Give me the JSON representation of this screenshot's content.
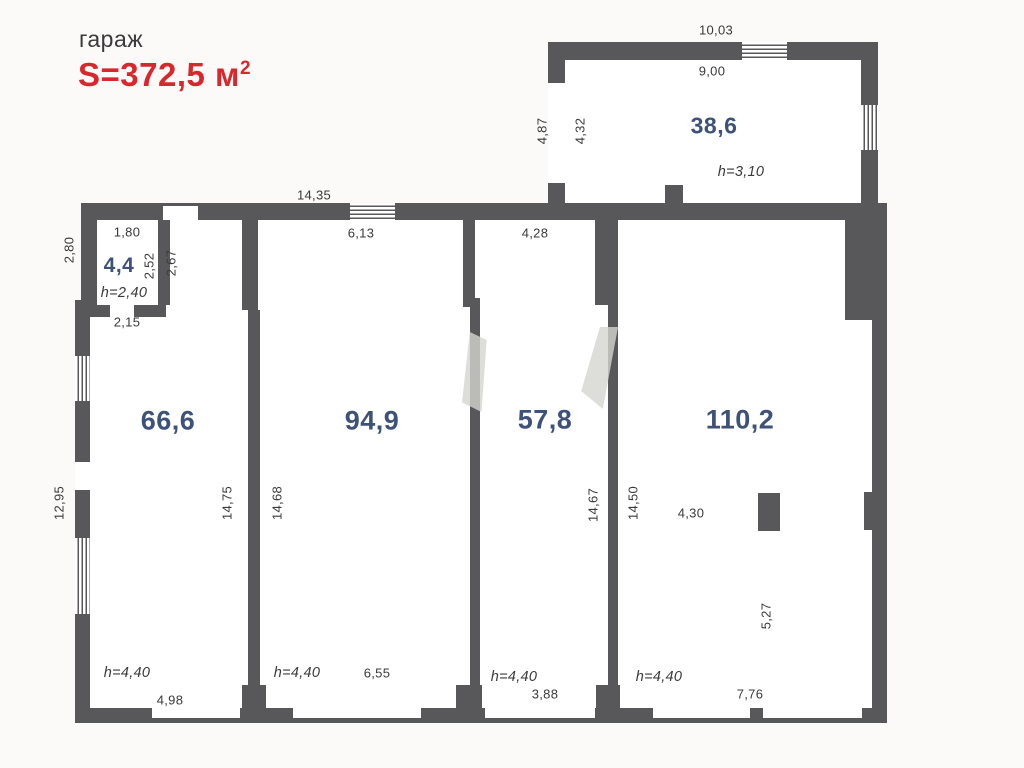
{
  "header": {
    "building_type": "гараж",
    "total_area": "S=372,5 м",
    "total_area_sup": "2"
  },
  "colors": {
    "accent_red": "#d7282e",
    "wall_gray": "#58585a",
    "room_label_blue": "#3e5278"
  },
  "rooms": {
    "r44": {
      "area": "4,4",
      "h": "h=2,40"
    },
    "r66": {
      "area": "66,6",
      "h": "h=4,40"
    },
    "r94": {
      "area": "94,9",
      "h": "h=4,40"
    },
    "r57": {
      "area": "57,8",
      "h": "h=4,40"
    },
    "r110": {
      "area": "110,2",
      "h": "h=4,40"
    },
    "r38": {
      "area": "38,6",
      "h": "h=3,10"
    }
  },
  "dims": {
    "main_top": "14,35",
    "annex_top_outer": "10,03",
    "annex_top_inner": "9,00",
    "annex_left_outer": "4,87",
    "annex_left_inner": "4,32",
    "left_upper": "2,80",
    "left_lower": "12,95",
    "r44_width": "1,80",
    "r44_height_inner": "2,52",
    "entry_height": "2,67",
    "r44_bottom": "2,15",
    "r66_depth": "14,75",
    "r66_bottom": "4,98",
    "r94_top": "6,13",
    "r94_depth": "14,68",
    "r94_bottom": "6,55",
    "r57_top": "4,28",
    "r57_depth": "14,67",
    "r57_bottom": "3,88",
    "r110_depth": "14,50",
    "r110_to_pillar": "4,30",
    "r110_pillar_to_wall": "5,27",
    "r110_bottom": "7,76"
  }
}
